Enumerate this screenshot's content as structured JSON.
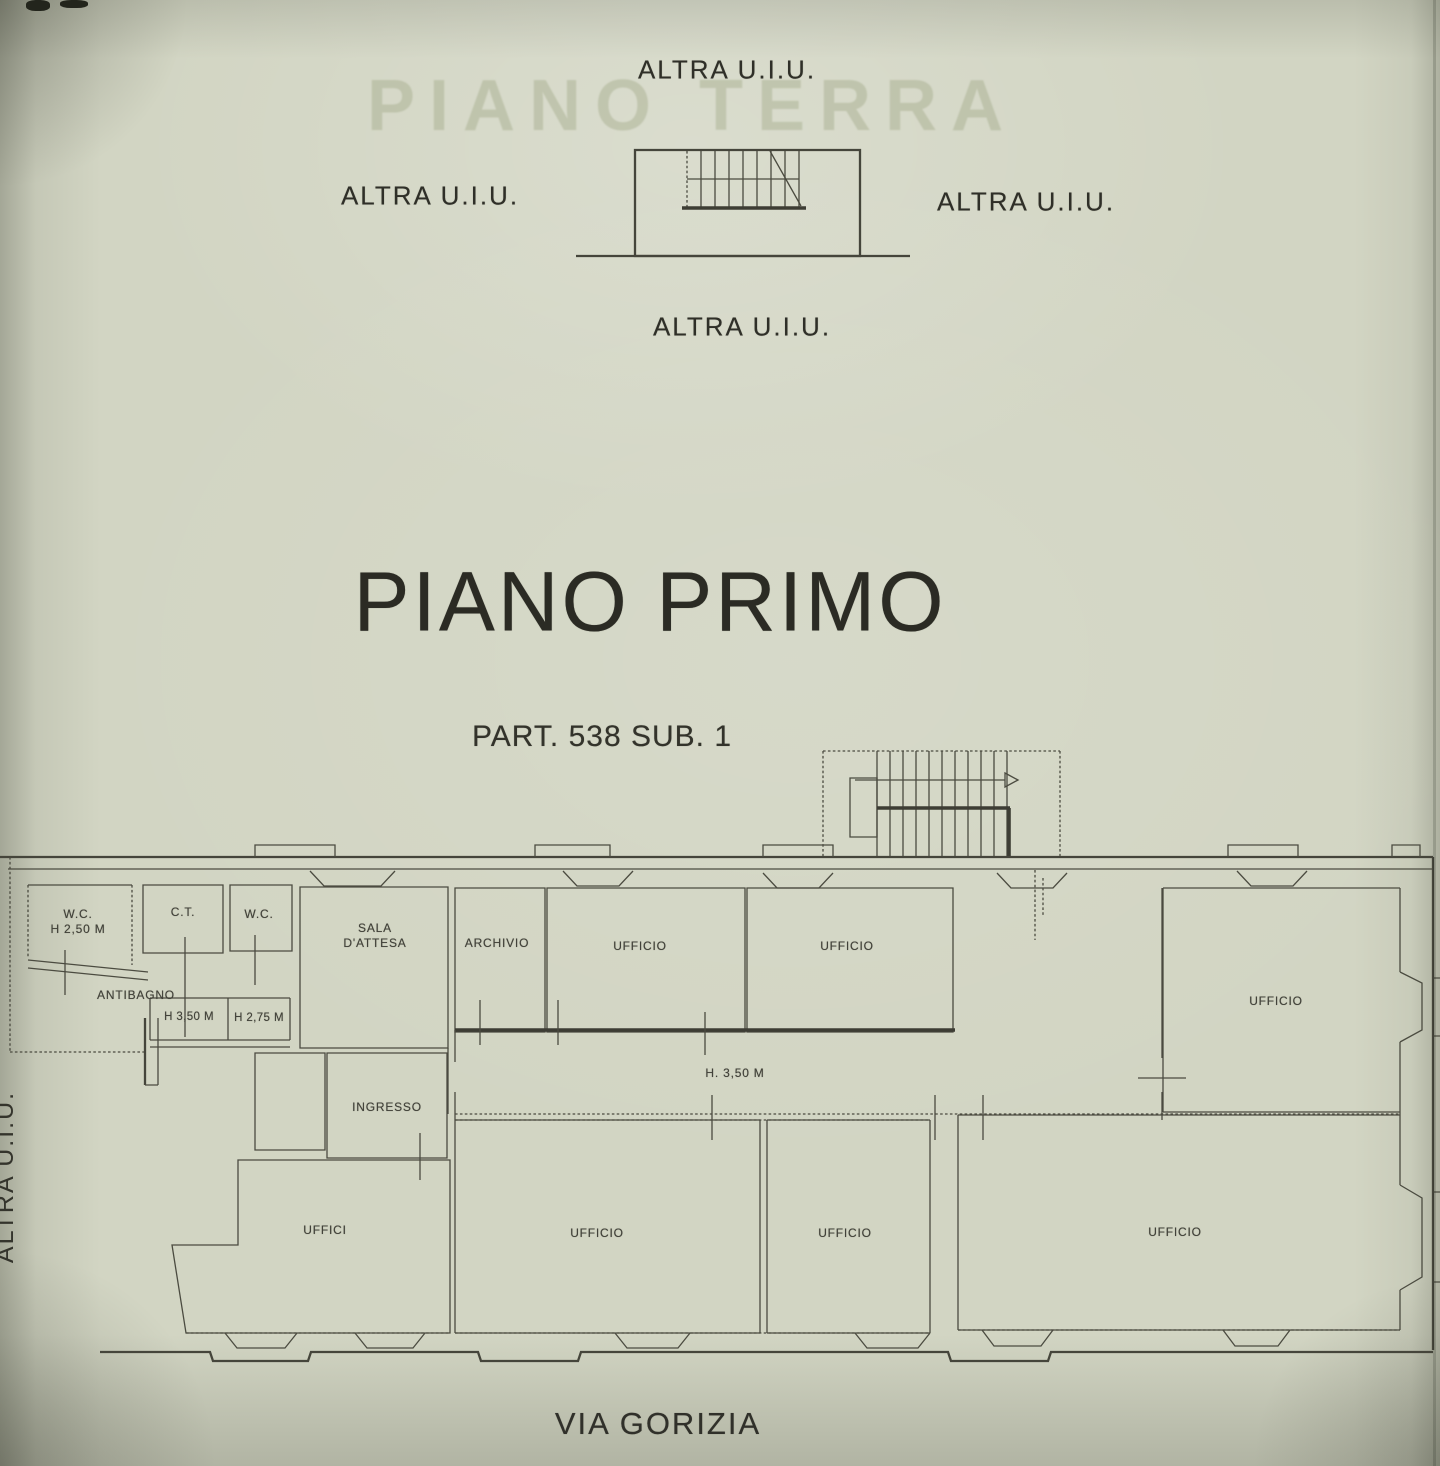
{
  "document": {
    "title": "PIANO PRIMO",
    "parcel_ref": "PART. 538 SUB. 1",
    "street_name": "VIA GORIZIA",
    "watermark_showthrough": "PIANO TERRA"
  },
  "adjacent": {
    "top": "ALTRA U.I.U.",
    "left": "ALTRA U.I.U.",
    "right": "ALTRA U.I.U.",
    "bottom": "ALTRA U.I.U.",
    "side_vertical": "ALTRA U.I.U."
  },
  "rooms": {
    "wc_1": "W.C.",
    "wc_1_height": "H 2,50 M",
    "ct": "C.T.",
    "wc_2": "W.C.",
    "antibagno": "ANTIBAGNO",
    "room_h_350": "H 3,50 M",
    "room_h_275": "H 2,75 M",
    "sala_dattesa_line_1": "SALA",
    "sala_dattesa_line_2": "D'ATTESA",
    "archivio": "ARCHIVIO",
    "ufficio_top_1": "UFFICIO",
    "ufficio_top_2": "UFFICIO",
    "ufficio_right": "UFFICIO",
    "corridor_height": "H. 3,50 M",
    "ingresso": "INGRESSO",
    "uffici": "UFFICI",
    "ufficio_bottom_1": "UFFICIO",
    "ufficio_bottom_2": "UFFICIO",
    "ufficio_bottom_3": "UFFICIO"
  }
}
